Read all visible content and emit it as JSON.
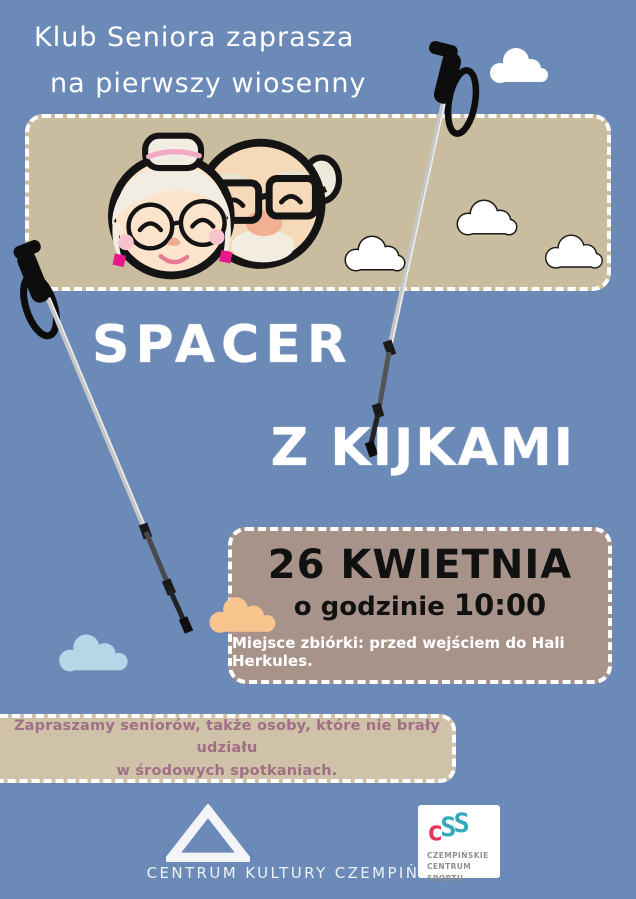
{
  "header": {
    "line1": "Klub Seniora zaprasza",
    "line2": "na pierwszy wiosenny"
  },
  "title": {
    "line1": "SPACER",
    "line2": "Z KIJKAMI"
  },
  "event": {
    "date": "26 KWIETNIA",
    "time_label": "o godzinie",
    "time_value": "10:00",
    "meeting_point": "Miejsce zbiórki: przed wejściem do Hali Herkules."
  },
  "note": {
    "line1": "Zapraszamy seniorów, także osoby, które nie brały udziału",
    "line2": "w środowych spotkaniach."
  },
  "footer": {
    "culture_center_label": "CENTRUM KULTURY CZEMPIŃ",
    "ccs": {
      "letters": [
        "c",
        "S",
        "S"
      ],
      "line1": "CZEMPIŃSKIE",
      "line2": "CENTRUM SPORTU"
    }
  },
  "icons": {
    "illustration": "grandparents-faces",
    "decorations": [
      "walking-pole-left",
      "walking-pole-right",
      "outlined-cloud",
      "white-cloud",
      "peach-cloud",
      "blue-cloud"
    ],
    "logos": [
      "triangle-mountain-logo",
      "ccs-logo"
    ]
  },
  "colors": {
    "background": "#6b8ab8",
    "hero_box": "#c9bc9f",
    "date_box": "#a8938a",
    "note_box": "#cfc2a8",
    "note_text": "#a06f85",
    "title_text": "#ffffff",
    "date_text": "#111111",
    "earring_magenta": "#e8188a",
    "ccs_red": "#e8335b",
    "ccs_teal": "#35a9bb",
    "peach_cloud": "#f8c48e",
    "blue_cloud": "#b5d8e8"
  }
}
